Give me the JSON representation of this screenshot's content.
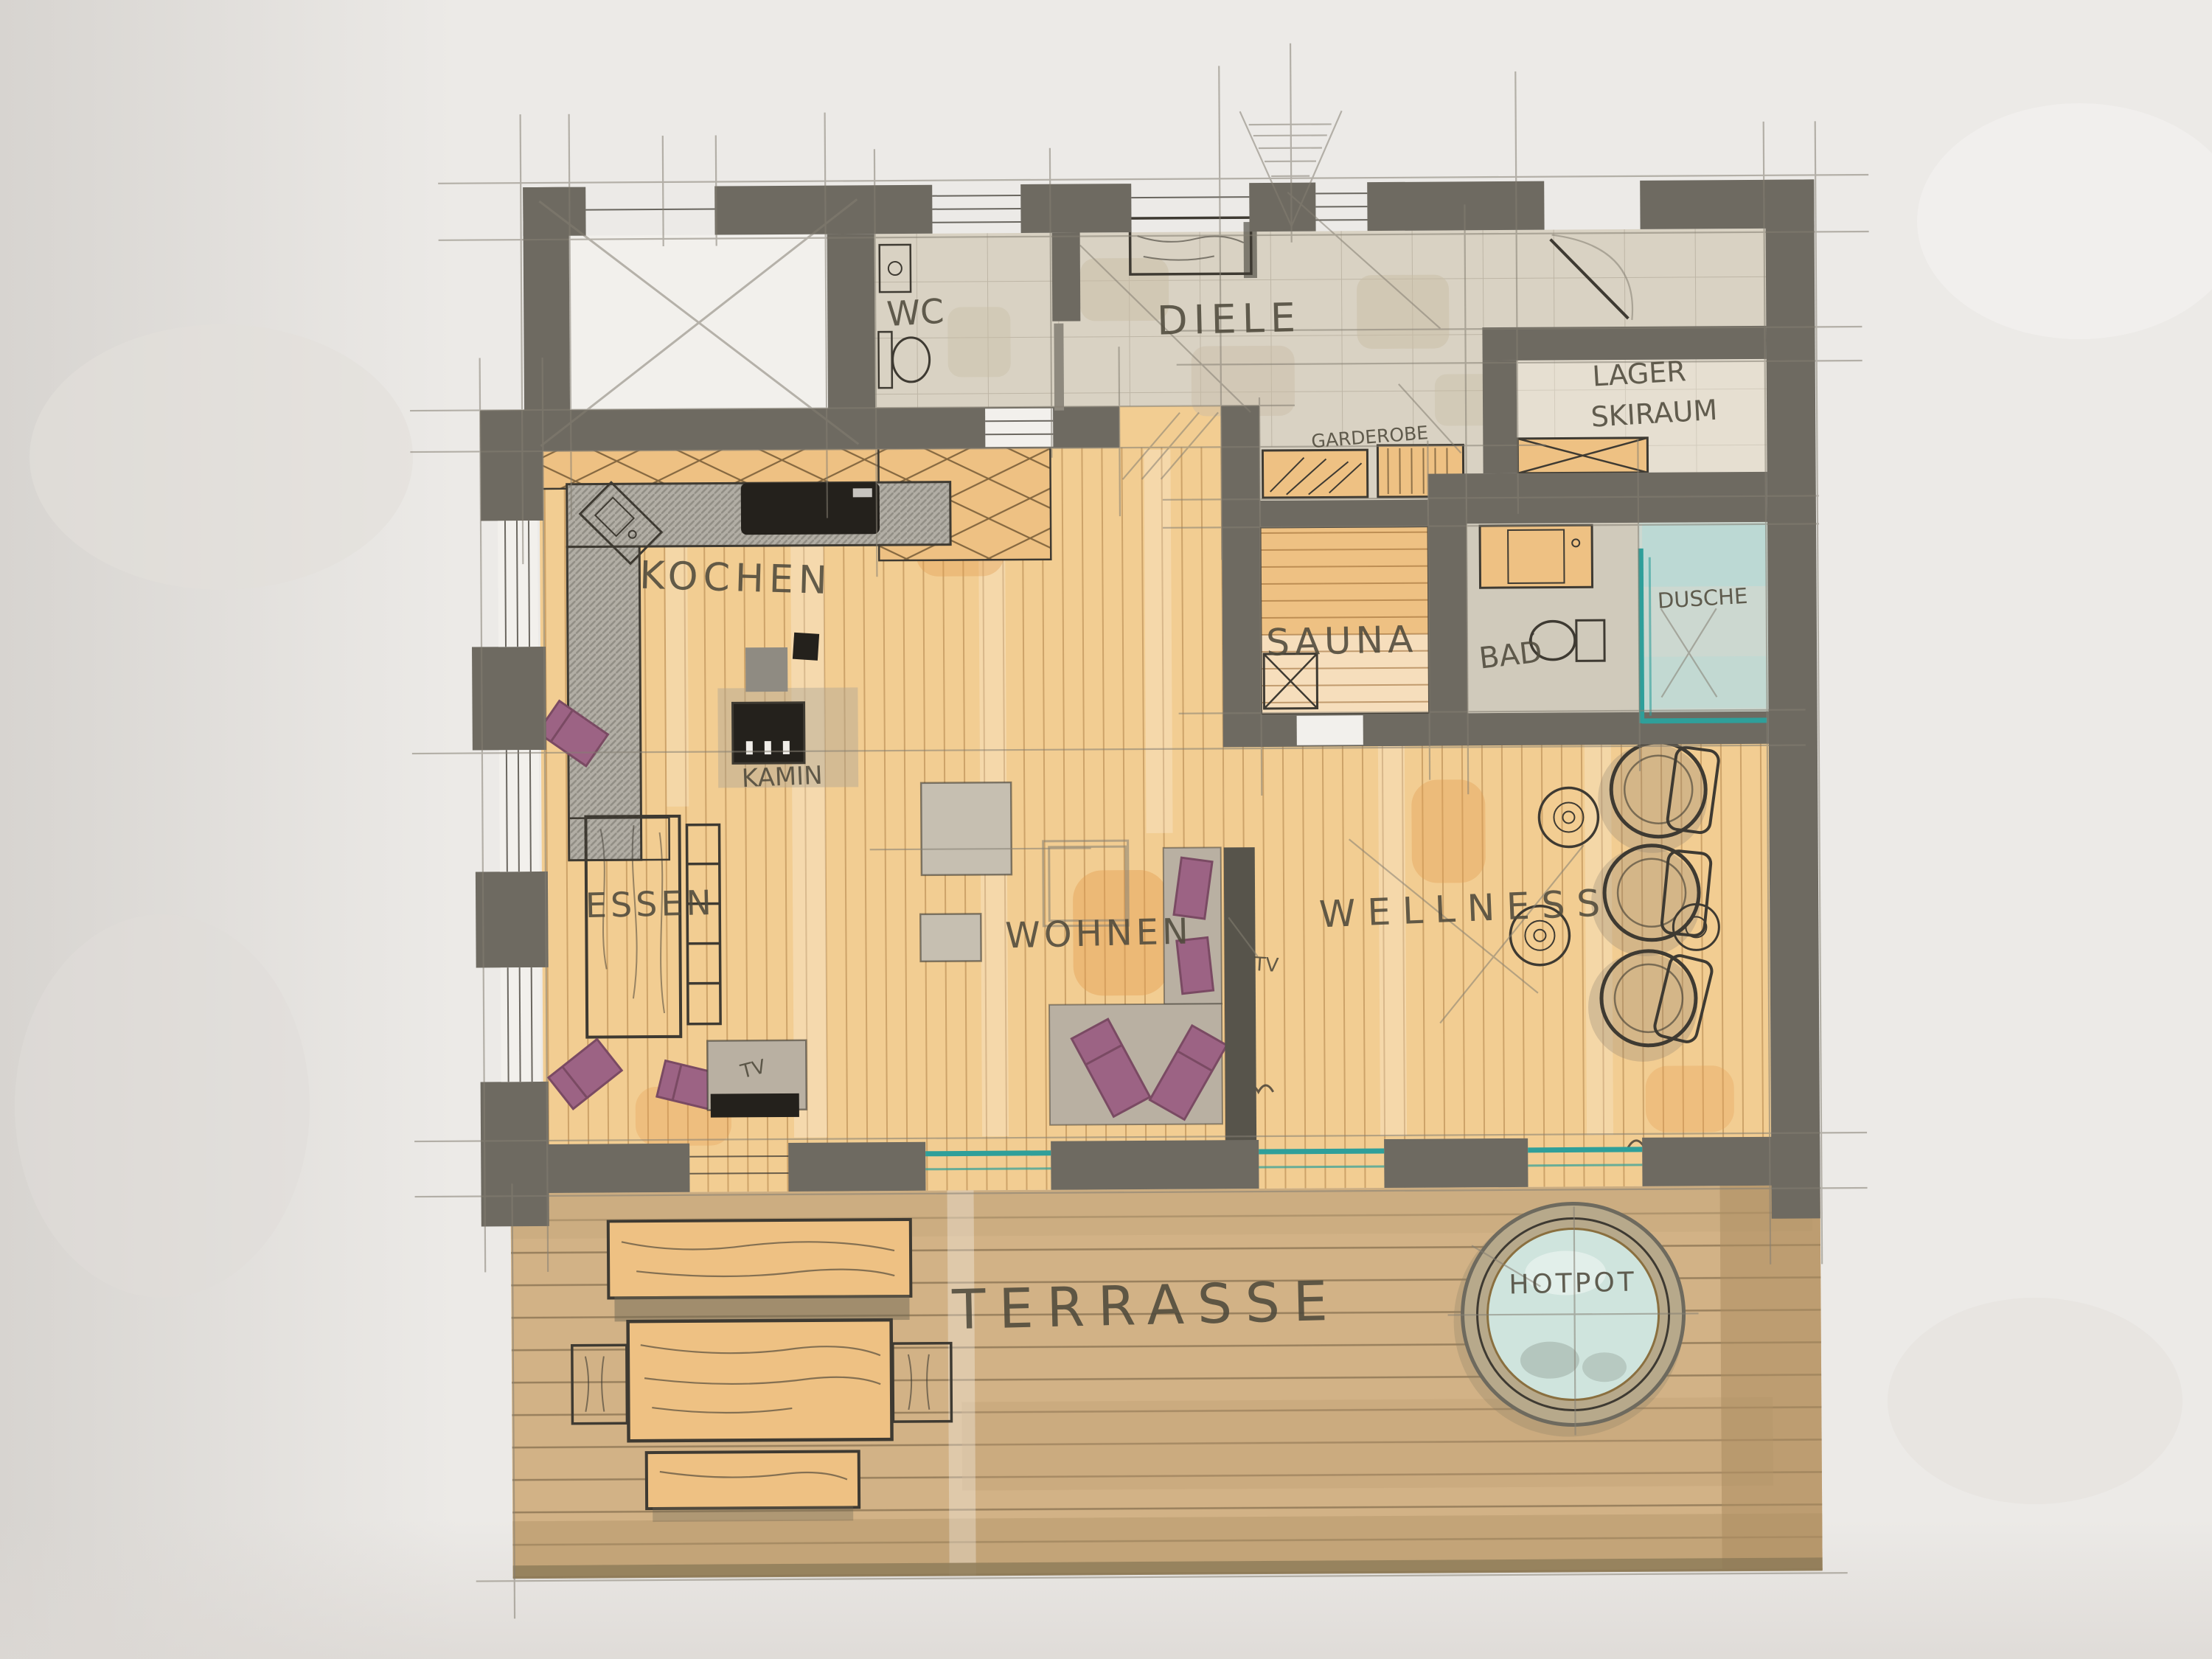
{
  "meta": {
    "type": "hand-drawn floor plan sketch",
    "medium": "marker and pencil on paper",
    "language": "German"
  },
  "palette": {
    "paper": "#eceae7",
    "paper_shadow": "#d8d5d1",
    "wall": "#6e6a61",
    "wall_dark": "#57544b",
    "wood": "#f2cd92",
    "wood_patch": "#e39a4e",
    "terrace": "#d2b286",
    "tile": "#d9d2c3",
    "lager": "#e6dfd1",
    "bath": "#d0cabb",
    "shower": "#ccd8d0",
    "teal": "#2f9f9a",
    "teal_wash": "#b8dad4",
    "purple": "#9c6384",
    "purple_dark": "#7a4a63",
    "counter": "#b2aea5",
    "sofa": "#b9b0a2",
    "pad": "#c6bfb1",
    "bench": "#eec183",
    "black": "#24211c",
    "ink": "#3e3a32",
    "pencil": "#857f73",
    "hand": "#4f4a3c",
    "hotpot_water": "#cfe4dd",
    "hotpot_rim": "#b7a98b"
  },
  "labels": {
    "wc": "WC",
    "diele": "DIELE",
    "garderobe": "GARDEROBE",
    "lager": "LAGER",
    "skiraum": "SKIRAUM",
    "sauna": "SAUNA",
    "bad": "BAD",
    "dusche": "DUSCHE",
    "kochen": "KOCHEN",
    "kamin": "KAMIN",
    "essen": "ESSEN",
    "tv_sideboard": "TV",
    "wohnen": "WOHNEN",
    "tv_wall": "TV",
    "wellness": "WELLNESS",
    "terrasse": "TERRASSE",
    "hotpot": "HOTPOT"
  }
}
